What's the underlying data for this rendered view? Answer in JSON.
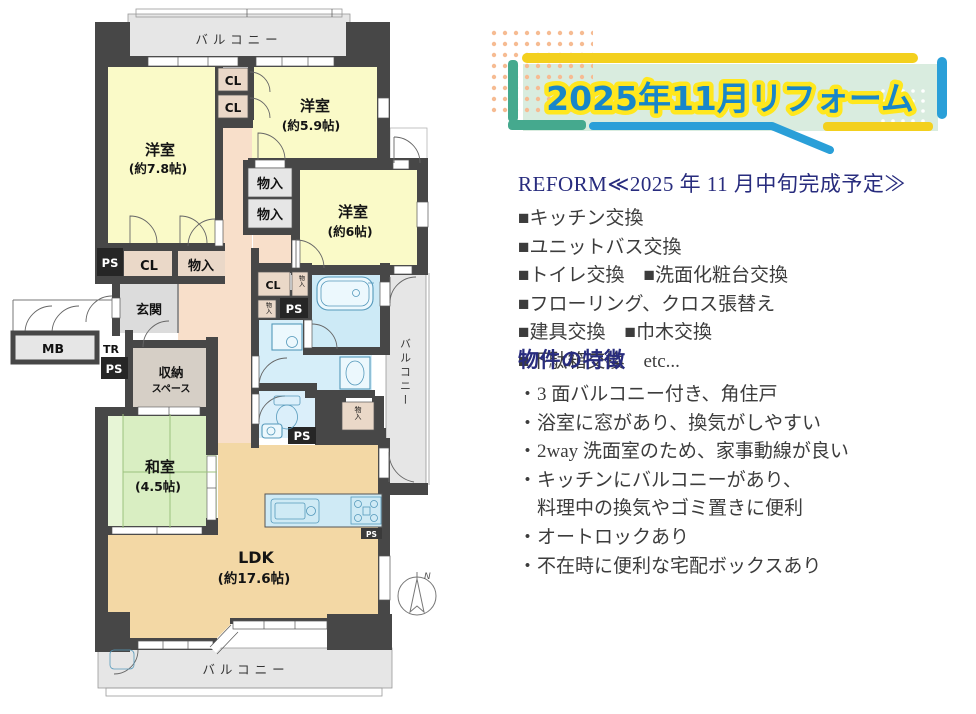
{
  "banner": {
    "title": "2025年11月リフォーム",
    "colors": {
      "title_blue": "#1886c9",
      "title_outline": "#ffe71e",
      "mint": "#d9ecdf",
      "yellow": "#f3d01e",
      "teal": "#45a98e",
      "blue": "#2a9fd8"
    }
  },
  "reform": {
    "heading": "REFORM≪2025 年 11 月中旬完成予定≫",
    "lines": [
      "■キッチン交換",
      "■ユニットバス交換",
      "■トイレ交換　■洗面化粧台交換",
      "■フローリング、クロス張替え",
      "■建具交換　■巾木交換",
      "■下駄箱交換　etc..."
    ]
  },
  "features": {
    "heading": "物件の特徴",
    "lines": [
      "・3 面バルコニー付き、角住戸",
      "・浴室に窓があり、換気がしやすい",
      "・2way 洗面室のため、家事動線が良い",
      "・キッチンにバルコニーがあり、",
      "　料理中の換気やゴミ置きに便利",
      "・オートロックあり",
      "・不在時に便利な宅配ボックスあり"
    ]
  },
  "plan": {
    "rooms": {
      "yo78": {
        "name": "洋室",
        "size": "(約7.8帖)"
      },
      "yo59": {
        "name": "洋室",
        "size": "(約5.9帖)"
      },
      "yo6": {
        "name": "洋室",
        "size": "(約6帖)"
      },
      "washitsu": {
        "name": "和室",
        "size": "(4.5帖)"
      },
      "ldk": {
        "name": "LDK",
        "size": "(約17.6帖)"
      },
      "genkan": "玄関",
      "shuno1": "収納",
      "shuno2": "スペース"
    },
    "labels": {
      "balcony": "バルコニー",
      "cl": "CL",
      "ps": "PS",
      "monoiri": "物入",
      "mb": "MB",
      "tr": "TR",
      "north": "N"
    },
    "colors": {
      "wall": "#474747",
      "room_yellow": "#fafac8",
      "tatami_green": "#d9eec2",
      "ldk_tan": "#f3d8a5",
      "hall_peach": "#f8dfca",
      "bath_blue": "#cdeaf6",
      "closet_beige": "#ead8c8",
      "balcony_gray": "#e6e6e6"
    }
  }
}
